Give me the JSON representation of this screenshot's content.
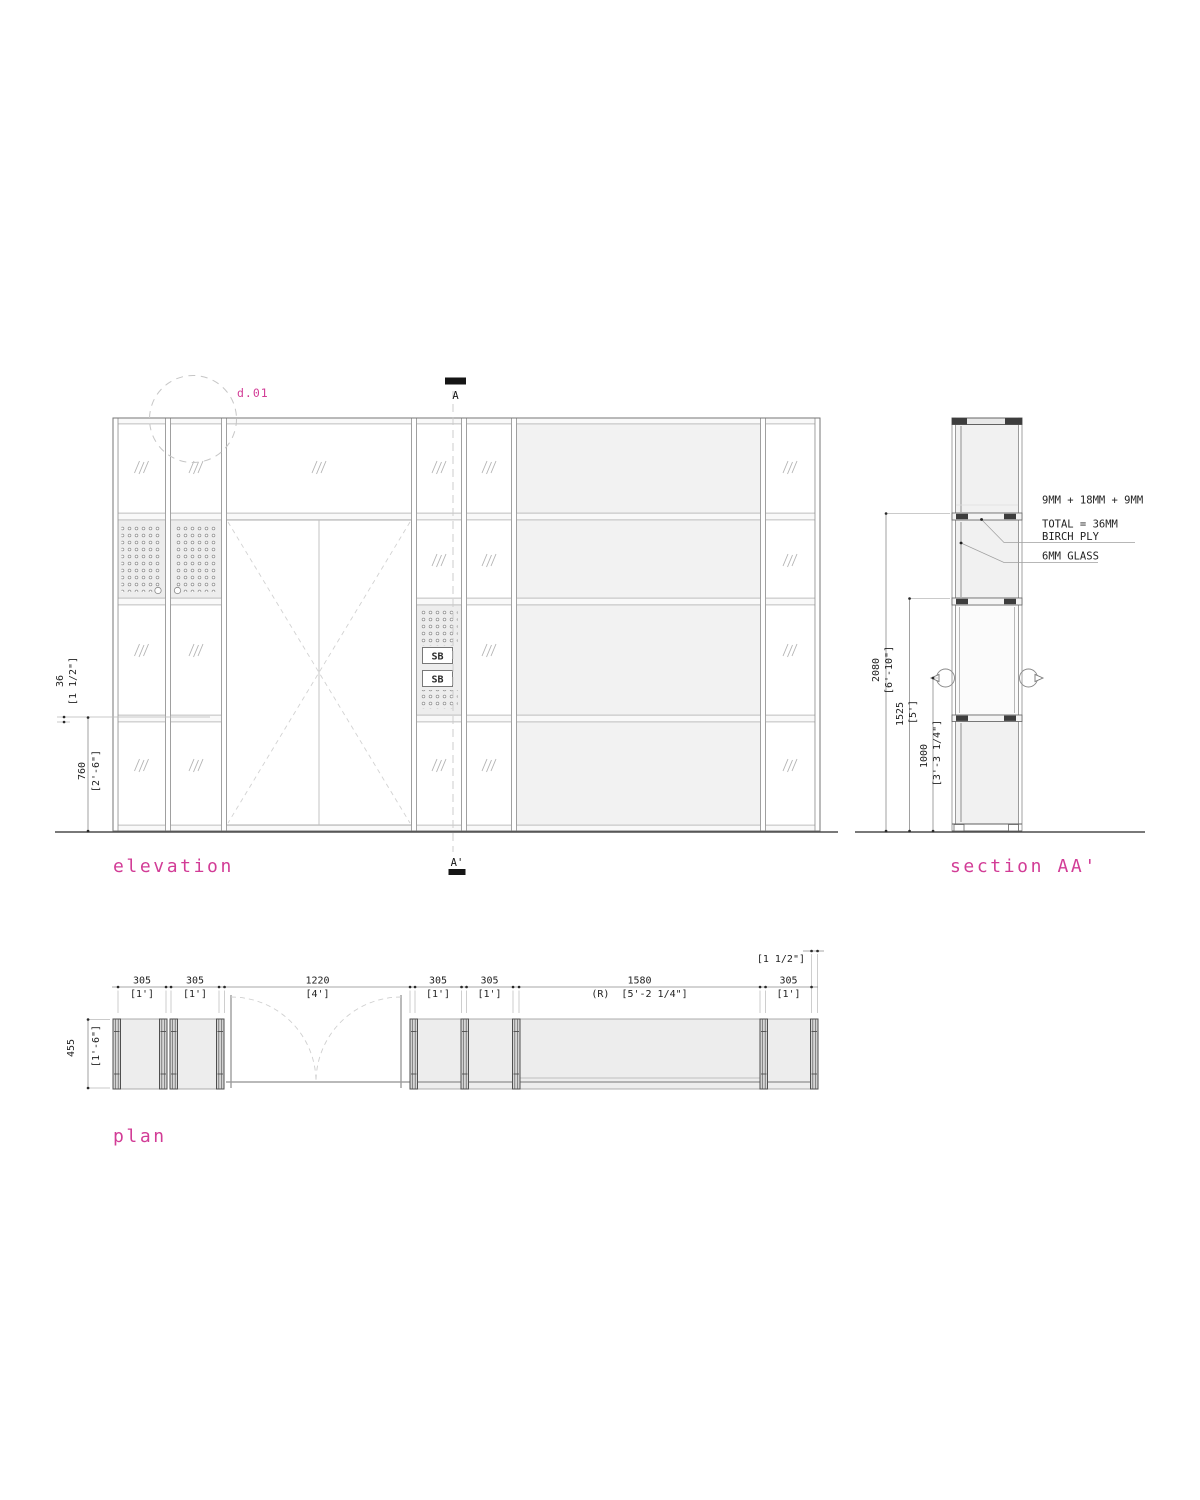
{
  "colors": {
    "accent": "#d23c96",
    "ink": "#1f1f1f",
    "frame_line": "#8f8f8f",
    "dark_block": "#3d3d3d",
    "panel_fill": "#f2f2f2",
    "perforated_fill": "#ededed",
    "dashed_light": "#cccccc"
  },
  "views": {
    "elevation": {
      "label": "elevation"
    },
    "section": {
      "label": "section AA'"
    },
    "plan": {
      "label": "plan"
    }
  },
  "detail_marker": {
    "label": "d.01"
  },
  "section_markers": {
    "top": "A",
    "bottom": "A'"
  },
  "sb_labels": [
    "SB",
    "SB"
  ],
  "annotations": {
    "ply_layup": "9MM + 18MM + 9MM",
    "ply_total": "TOTAL = 36MM",
    "ply_material": "BIRCH PLY",
    "glass": "6MM GLASS"
  },
  "dimensions": {
    "elevation_side": [
      {
        "mm": "36",
        "imperial": "[1 1/2\"]"
      },
      {
        "mm": "760",
        "imperial": "[2'-6\"]"
      }
    ],
    "section_side": [
      {
        "mm": "2080",
        "imperial": "[6'-10\"]"
      },
      {
        "mm": "1525",
        "imperial": "[5']"
      },
      {
        "mm": "1000",
        "imperial": "[3'-3 1/4\"]"
      }
    ],
    "plan_top": [
      {
        "mm": "305",
        "imperial": "[1']"
      },
      {
        "mm": "305",
        "imperial": "[1']"
      },
      {
        "mm": "1220",
        "imperial": "[4']"
      },
      {
        "mm": "305",
        "imperial": "[1']"
      },
      {
        "mm": "305",
        "imperial": "[1']"
      },
      {
        "mm": "1580",
        "imperial": "(R)  [5'-2 1/4\"]"
      },
      {
        "mm": "305",
        "imperial": "[1']"
      }
    ],
    "plan_post": "[1 1/2\"]",
    "plan_depth": {
      "mm": "455",
      "imperial": "[1'-6\"]"
    }
  }
}
